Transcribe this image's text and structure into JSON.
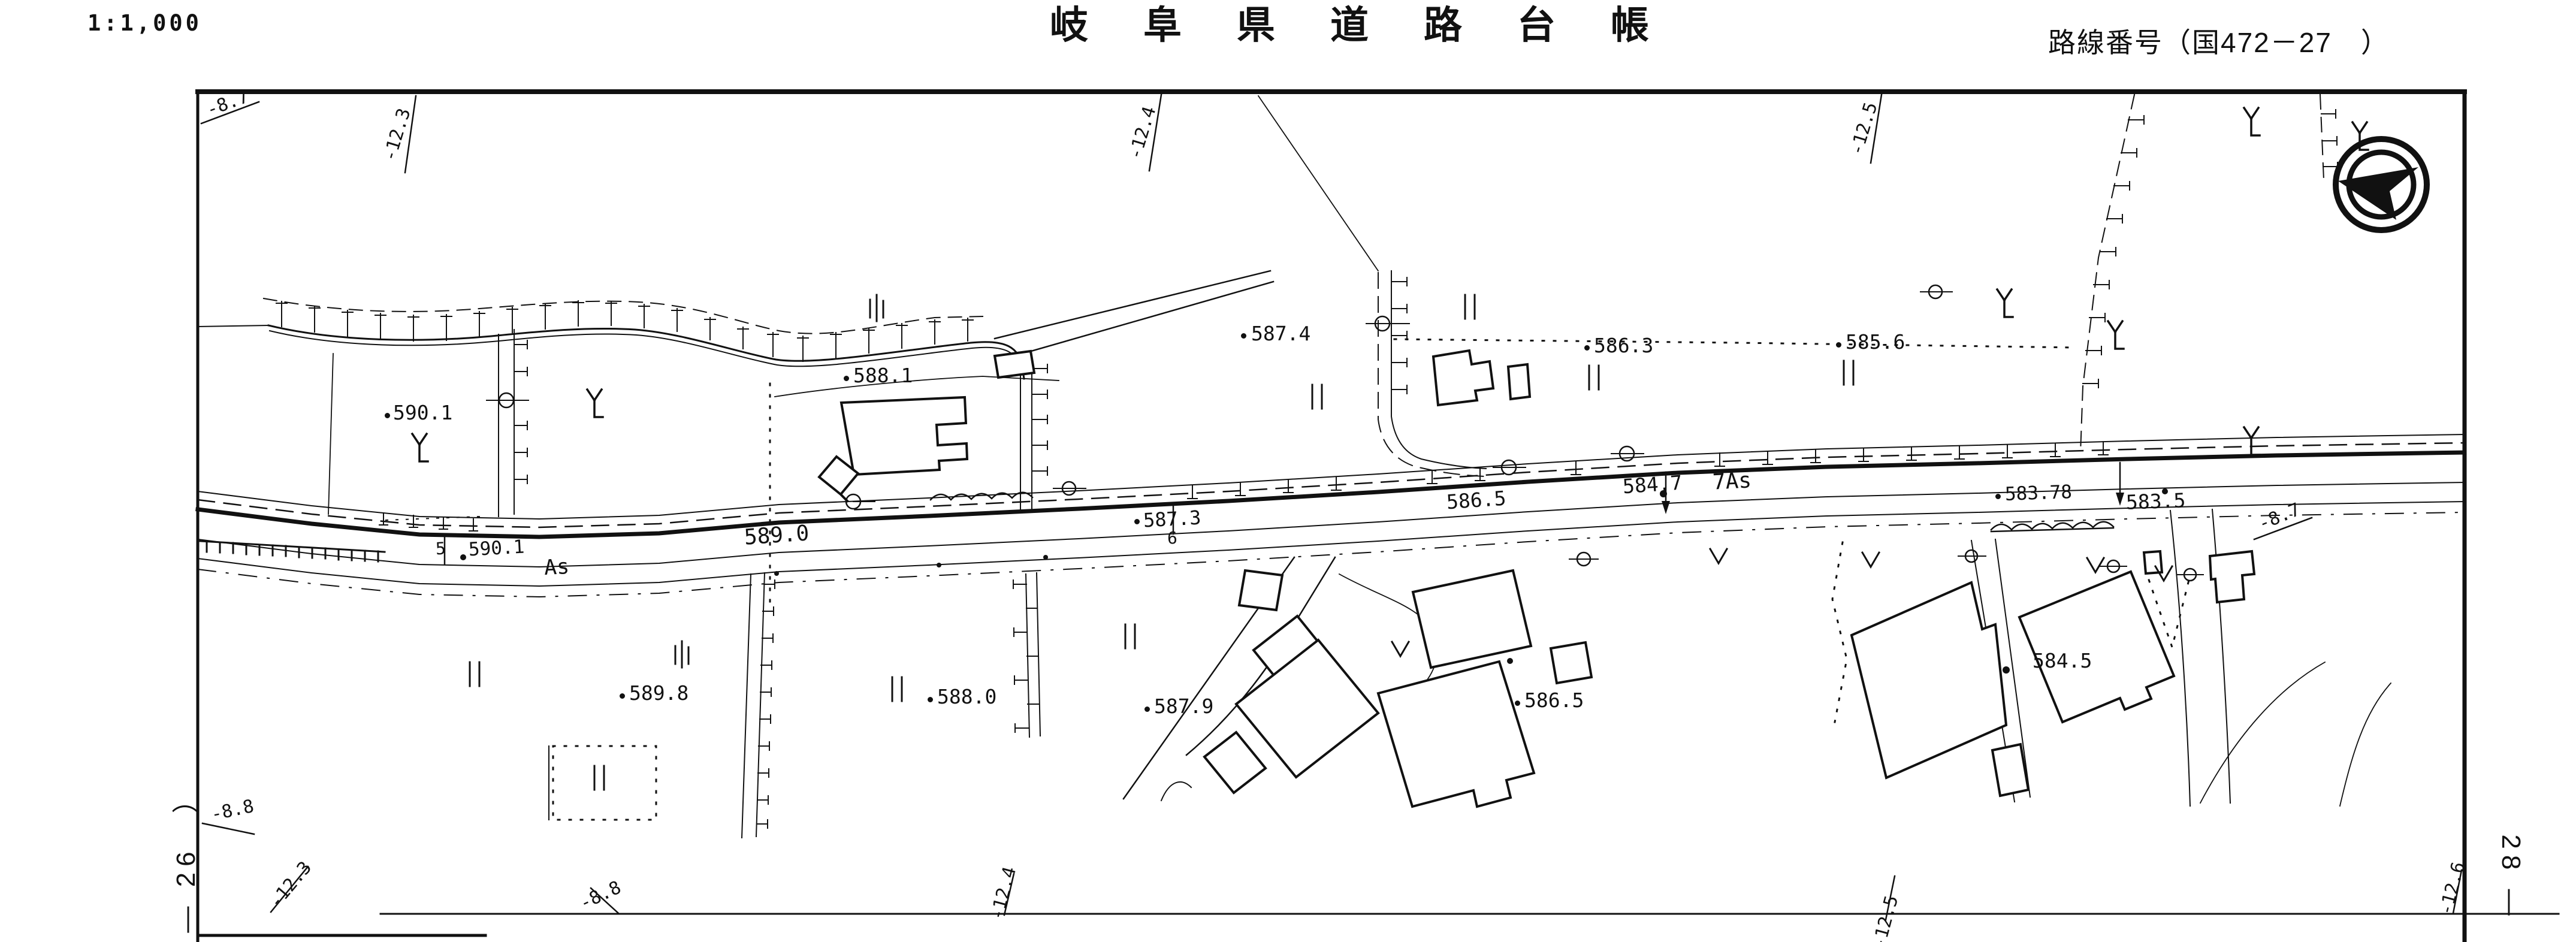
{
  "header": {
    "scale": "1:1,000",
    "title": "岐阜県道路台帳",
    "route_label": "路線番号（国472－27　）"
  },
  "sheet_refs": {
    "left": "― 26　）",
    "right": "28 ―"
  },
  "grid_labels": {
    "top_87": "-8.7",
    "top_123": "-12.3",
    "top_124": "-12.4",
    "top_125": "-12.5",
    "right_87": "-8.7",
    "left_88": "-8.8",
    "bottom_123": "-12.3",
    "bottom_88": "-8.8",
    "bottom_124": "-12.4",
    "bottom_125": "-12.5",
    "bottom_126": "-12.6"
  },
  "road": {
    "station5": "5",
    "station5_elev": "590.1",
    "surface_as": "As",
    "elev_589_0": "589.0",
    "elev_586_5": "586.5",
    "elev_584_7": "584.7",
    "station7_as": "7As",
    "elev_583_78": "583.78",
    "elev_583_5": "583.5",
    "station6_elev": "587.3",
    "station6": "6"
  },
  "spot_heights": {
    "s590_1": "590.1",
    "s588_1": "588.1",
    "s587_4": "587.4",
    "s586_3": "586.3",
    "s585_6": "585.6",
    "s589_8": "589.8",
    "s588_0": "588.0",
    "s587_9": "587.9",
    "s586_5": "586.5",
    "s584_5": "584.5"
  },
  "symbols": {
    "compass": "north-arrow",
    "paddy_mark": "rice-field",
    "mulberry_mark": "mulberry-field",
    "field_mark": "upland-field",
    "pole_mark": "utility-pole"
  },
  "colors": {
    "ink": "#111111",
    "paper": "#ffffff"
  }
}
